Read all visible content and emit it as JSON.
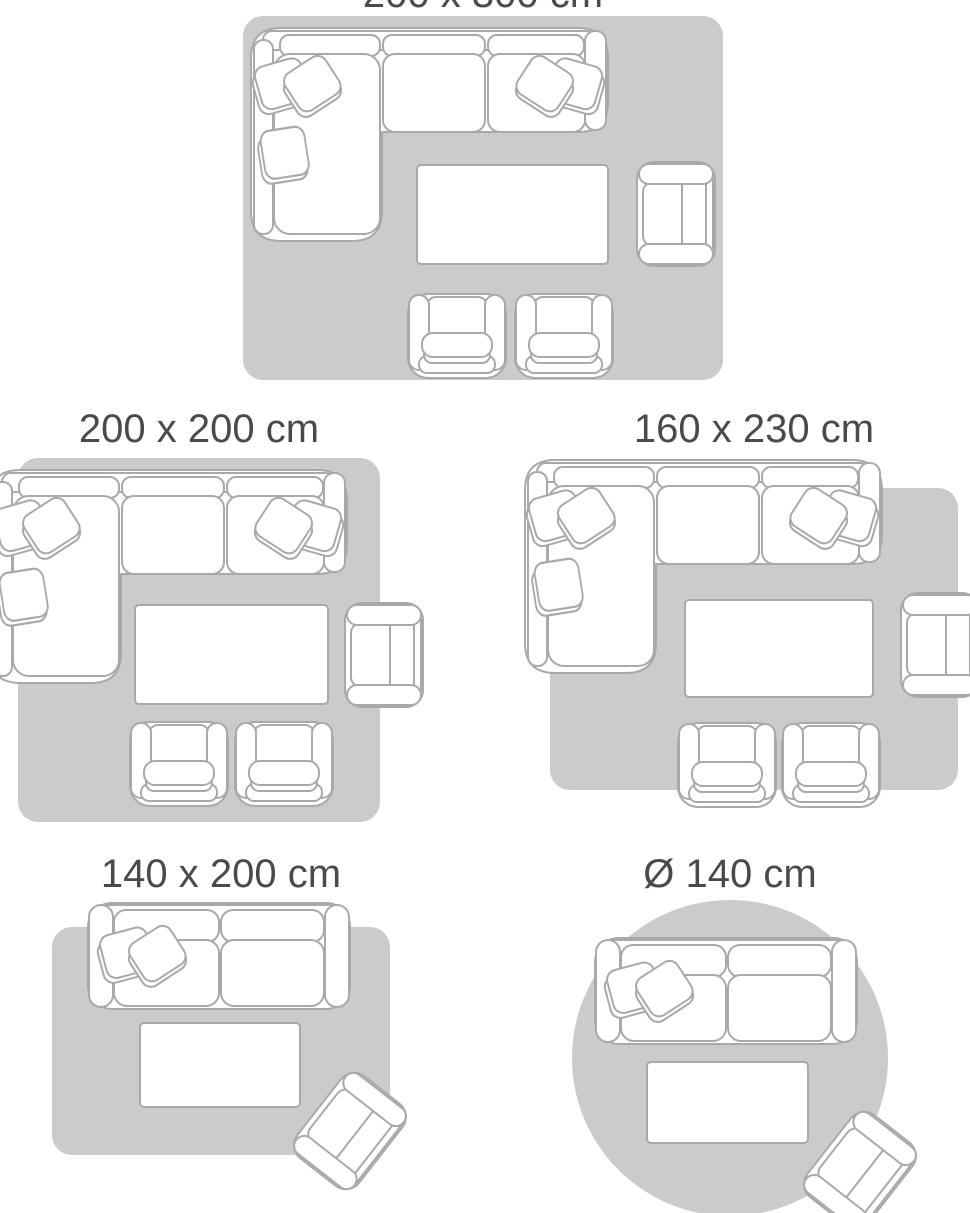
{
  "colors": {
    "background": "#ffffff",
    "rug": "#cbcbcb",
    "furniture_fill": "#ffffff",
    "furniture_outline": "#a9a9a9",
    "label_text": "#4a4a4a"
  },
  "size_guide": {
    "layouts": [
      {
        "id": "200x300",
        "label": "200 x 300 cm",
        "rug_shape": "rectangle",
        "furniture": [
          "corner-sofa",
          "coffee-table",
          "armchair-side",
          "armchair-front",
          "armchair-front"
        ]
      },
      {
        "id": "200x200",
        "label": "200 x 200 cm",
        "rug_shape": "square",
        "furniture": [
          "corner-sofa",
          "coffee-table",
          "armchair-side",
          "armchair-front",
          "armchair-front"
        ]
      },
      {
        "id": "160x230",
        "label": "160 x 230 cm",
        "rug_shape": "rectangle",
        "furniture": [
          "corner-sofa",
          "coffee-table",
          "armchair-side",
          "armchair-front",
          "armchair-front"
        ]
      },
      {
        "id": "140x200",
        "label": "140 x 200 cm",
        "rug_shape": "rectangle",
        "furniture": [
          "two-seat-sofa",
          "coffee-table",
          "armchair-side"
        ]
      },
      {
        "id": "140-round",
        "label": "Ø 140 cm",
        "rug_shape": "circle",
        "furniture": [
          "two-seat-sofa",
          "coffee-table",
          "armchair-side"
        ]
      }
    ]
  }
}
